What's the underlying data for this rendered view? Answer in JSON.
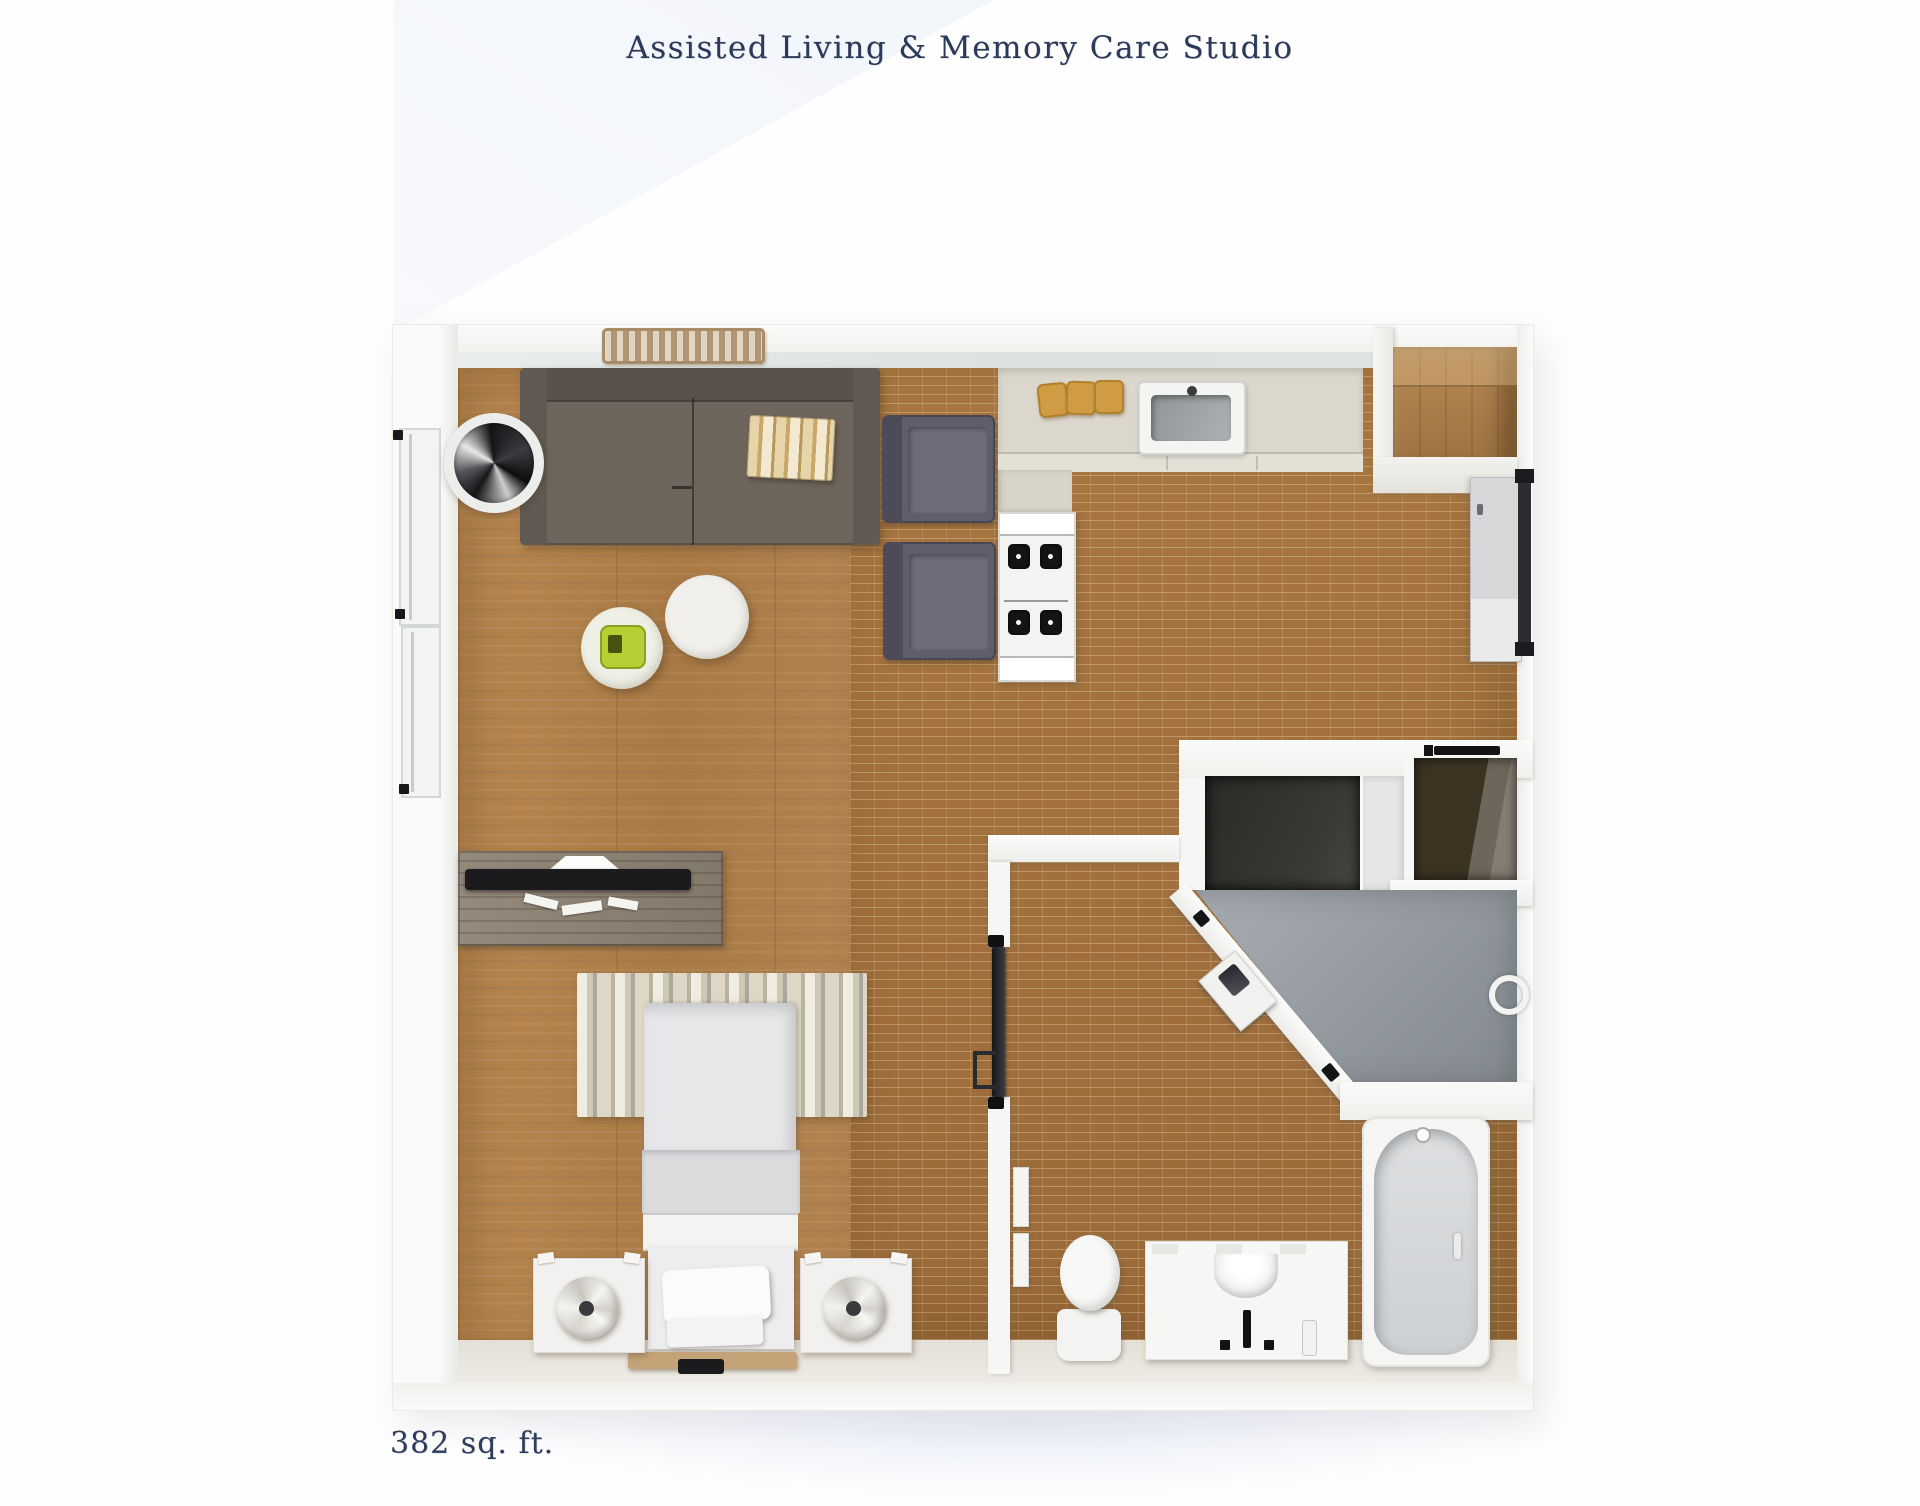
{
  "header": {
    "title": "Assisted Living & Memory Care Studio"
  },
  "footer": {
    "area_label": "382 sq. ft."
  },
  "palette": {
    "title_text": "#2b3a58",
    "page_background": "#fdfdfd",
    "wall_white": "#f6f6f4",
    "plank_floor": "#b08049",
    "brick_floor": "#a1703d",
    "kitchen_counter": "#dbd7cc",
    "sofa_gray": "#6e665d",
    "armchair_gray": "#615e6b",
    "closet_interior_dark": "#2c2a27",
    "wardrobe_interior_brown": "#3c3323",
    "shower_floor_gray": "#9aa0a5",
    "fixture_white": "#f5f5f3",
    "tray_green": "#b7ce34",
    "cutting_board_tan": "#cf9b43",
    "entry_rug_tan": "#cbb191",
    "bench_wood_tan": "#c3a377"
  },
  "furniture": [
    "entry-rug",
    "sofa",
    "book-stack",
    "floor-fan-decor",
    "coffee-table",
    "coffee-table-with-tray",
    "armchair",
    "armchair",
    "kitchen-counter",
    "cutting-boards",
    "kitchen-sink",
    "stove",
    "entry-alcove",
    "storage-panel",
    "door-track",
    "walk-in-closet",
    "closet-rod",
    "wardrobe",
    "shower",
    "shower-seat",
    "towel-ring",
    "bathtub",
    "toilet",
    "bathroom-vanity",
    "bathroom-door",
    "towel-bar",
    "desk",
    "monitor",
    "keyboard",
    "area-rug",
    "bed",
    "pillow",
    "foot-bench",
    "nightstand",
    "nightstand",
    "table-lamp",
    "table-lamp",
    "windows"
  ]
}
